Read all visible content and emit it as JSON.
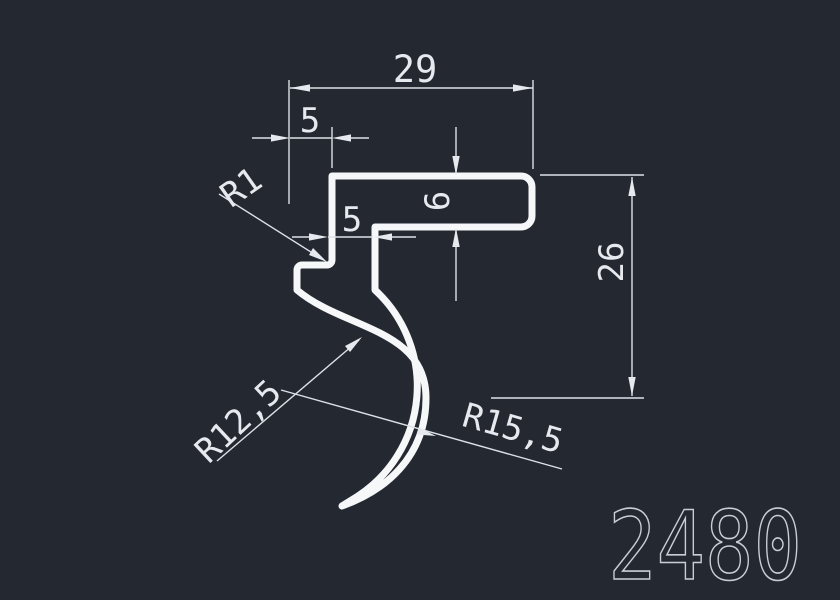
{
  "drawing": {
    "type": "profile-cross-section",
    "part_number": "2480",
    "dims": {
      "top_width": "29",
      "hook_overhang": "5",
      "bar_thickness": "6",
      "step_width": "5",
      "overall_height": "26",
      "fillet_radius": "R1",
      "inner_radius": "R12,5",
      "outer_radius": "R15,5"
    },
    "colors": {
      "background": "#242831",
      "profile_line": "#f5f7f9",
      "dimension_line": "#dde1e8",
      "dimension_text": "#e6e9ee",
      "part_number_text": "#c9ced6"
    }
  }
}
